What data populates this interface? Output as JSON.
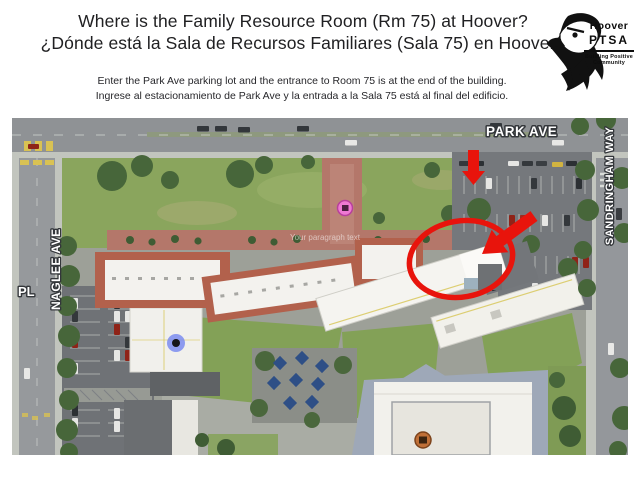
{
  "header": {
    "title_line1": "Where is the Family Resource Room (Rm 75) at Hoover?",
    "title_line2": "¿Dónde está la Sala de Recursos Familiares (Sala 75) en Hoover?",
    "instruction_line1": "Enter the Park Ave parking lot and the entrance to Room 75 is at the end of the building.",
    "instruction_line2": "Ingrese al estacionamiento de Park Ave y la entrada a la Sala 75 está al final del edificio."
  },
  "logo": {
    "icon": "eagle-head-icon",
    "name_line1": "Hoover",
    "name_line2": "PTSA",
    "tagline_line1": "Building Positive",
    "tagline_line2": "Community"
  },
  "map": {
    "kind": "aerial-satellite-photo",
    "labels": {
      "park_ave": "PARK AVE",
      "sandringham": "SANDRINGHAM WAY",
      "naglee": "NAGLEE AVE",
      "pl": "PL"
    },
    "watermark": "Your paragraph text",
    "annotation_color": "#e8140c",
    "annotations": [
      {
        "name": "parking-entrance-arrow",
        "shape": "red-arrow-down"
      },
      {
        "name": "room75-circle",
        "shape": "red-ellipse-outline"
      },
      {
        "name": "room75-arrow",
        "shape": "red-arrow-down-left"
      }
    ],
    "markers": [
      {
        "name": "school-pin",
        "color": "#ef79d3"
      },
      {
        "name": "blue-location-dot",
        "color": "#7b8cf0"
      },
      {
        "name": "building-pin",
        "color": "#c07038"
      }
    ]
  }
}
